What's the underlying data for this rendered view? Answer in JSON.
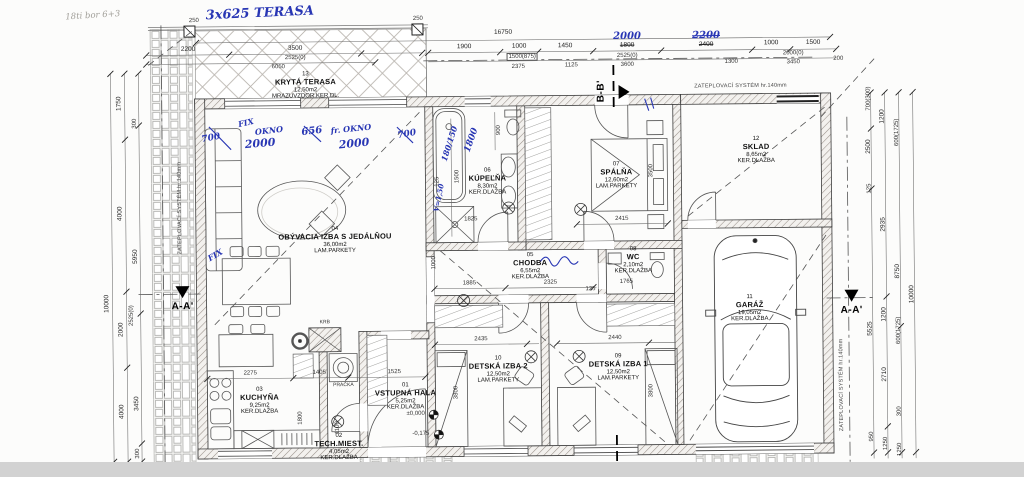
{
  "rooms": [
    {
      "num": "01",
      "name": "VSTUPNÁ HALA",
      "area": "5,25m2",
      "floor": "KER.DLAŽBA"
    },
    {
      "num": "02",
      "name": "TECH.MIEST.",
      "area": "4,05m2",
      "floor": "KER.DLAŽBA"
    },
    {
      "num": "03",
      "name": "KUCHYŇA",
      "area": "9,25m2",
      "floor": "KER.DLAŽBA"
    },
    {
      "num": "04",
      "name": "OBÝVACIA IZBA S JEDÁLŇOU",
      "area": "36,00m2",
      "floor": "LAM.PARKETY"
    },
    {
      "num": "05",
      "name": "CHODBA",
      "area": "6,55m2",
      "floor": "KER.DLAŽBA"
    },
    {
      "num": "06",
      "name": "KÚPEĽŇA",
      "area": "8,30m2",
      "floor": "KER.DLAŽBA"
    },
    {
      "num": "07",
      "name": "SPÁLŇA",
      "area": "12,60m2",
      "floor": "LAM.PARKETY"
    },
    {
      "num": "08",
      "name": "WC",
      "area": "2,10m2",
      "floor": "KER.DLAŽBA"
    },
    {
      "num": "09",
      "name": "DETSKÁ IZBA 1",
      "area": "12,50m2",
      "floor": "LAM.PARKETY"
    },
    {
      "num": "10",
      "name": "DETSKÁ IZBA 2",
      "area": "12,50m2",
      "floor": "LAM.PARKETY"
    },
    {
      "num": "11",
      "name": "GARÁŽ",
      "area": "19,05m2",
      "floor": "KER.DLAŽBA"
    },
    {
      "num": "12",
      "name": "SKLAD",
      "area": "8,65m2",
      "floor": "KER.DLAŽBA"
    },
    {
      "num": "13",
      "name": "KRYTÁ TERASA",
      "area": "12,50m2",
      "floor": "MRAZUVZDOR.KER.DL."
    }
  ],
  "labels": {
    "krb": "KRB",
    "pracka": "PRAČKA",
    "insulation": "ZATEPLOVACÍ SYSTÉM hr.140mm",
    "section_b": "B-B'",
    "section_a": "A-A'",
    "level_zero": "±0,000",
    "level_minus": "-0,175",
    "pencil_note": "18ti bor 6+3"
  },
  "dims": {
    "top": [
      "2200",
      "3500",
      "2525(0)",
      "6050",
      "16750",
      "1900",
      "1000",
      "1500(875)",
      "2375",
      "1450",
      "1125",
      "1800",
      "2525(0)",
      "3600",
      "1300",
      "2400",
      "1000",
      "1500",
      "2000(0)",
      "3450",
      "200",
      "250",
      "250"
    ],
    "left": [
      "1750",
      "300",
      "4000",
      "5950",
      "2000",
      "2525(0)",
      "10000",
      "4000",
      "3450",
      "300"
    ],
    "right": [
      "700(300)",
      "2500",
      "1200",
      "600(1725)",
      "125",
      "2935",
      "8750",
      "10000",
      "5525",
      "1200",
      "600(1725)",
      "2710",
      "300",
      "950",
      "1250",
      "1250"
    ],
    "inner": [
      "1885",
      "2325",
      "125",
      "1765",
      "2435",
      "2440",
      "2415",
      "3500",
      "1500",
      "900",
      "1825",
      "2275",
      "1405",
      "1525",
      "1800",
      "1100",
      "3800",
      "3800",
      "1000",
      "125"
    ]
  },
  "blue": {
    "terasa": "3x625 TERASA",
    "w700a": "700",
    "fix": "FIX",
    "okno": "OKNO",
    "w2000a": "2000",
    "w656": "656",
    "frokno": "fr. OKNO",
    "w2000b": "2000",
    "w700b": "700",
    "d2000": "2000",
    "d2200": "2200",
    "b180": "180/150",
    "b1800": "1800",
    "v150": "V=1,50",
    "fix2": "FIX"
  }
}
